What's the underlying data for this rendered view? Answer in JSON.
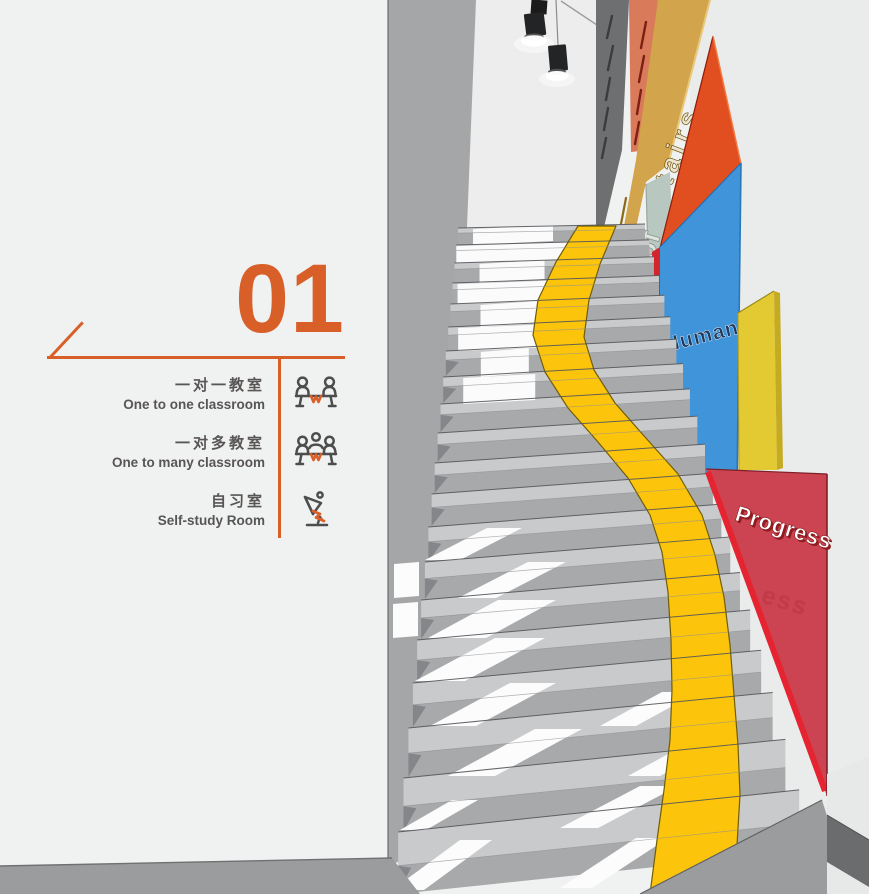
{
  "info_panel": {
    "section_number": "01",
    "accent_color": "#d95f28",
    "rooms": [
      {
        "zh": "一对一教室",
        "en": "One to one classroom",
        "icon": "one-to-one-classroom-icon"
      },
      {
        "zh": "一对多教室",
        "en": "One to many classroom",
        "icon": "one-to-many-classroom-icon"
      },
      {
        "zh": "自习室",
        "en": "Self-study Room",
        "icon": "desk-lamp-icon"
      }
    ]
  },
  "stair_scene": {
    "wall_words": {
      "stairs": "stairs",
      "of": "of",
      "human": "Human",
      "progress": "Progress",
      "progress_echo": "ess"
    },
    "path_color": "#fcc50b",
    "panel_colors": {
      "dark_band": "#6e6f71",
      "salmon": "#d97a5b",
      "gold": "#d2a44b",
      "sage": "#b9c7c1",
      "orange": "#e14e1f",
      "blue": "#4094da",
      "yellow": "#e3ca33",
      "red": "#cc4351"
    }
  }
}
